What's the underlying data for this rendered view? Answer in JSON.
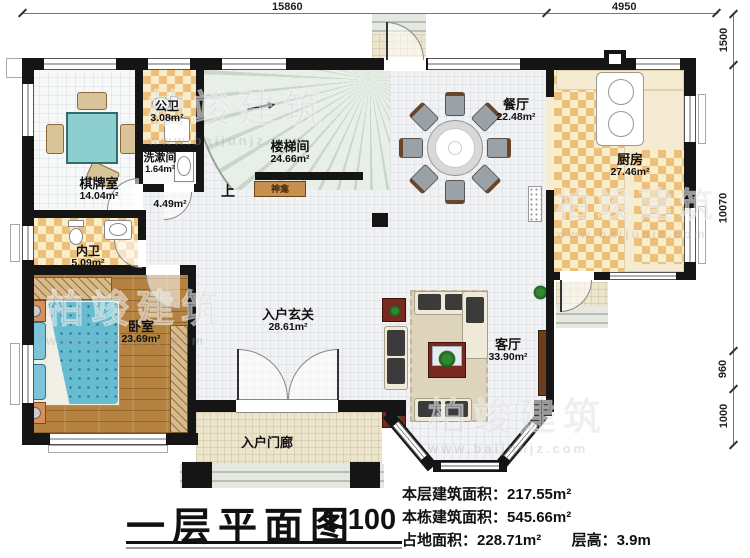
{
  "plan": {
    "title": "一层平面图",
    "scale": "1:100",
    "stats": {
      "line1_label": "本层建筑面积：",
      "line1_value": "217.55m²",
      "line2_label": "本栋建筑面积：",
      "line2_value": "545.66m²",
      "line3a_label": "占地面积：",
      "line3a_value": "228.71m²",
      "line3b_label": "层高：",
      "line3b_value": "3.9m"
    }
  },
  "dimensions": {
    "top_main": "15860",
    "top_right": "4950",
    "right_1": "1500",
    "right_2": "10070",
    "right_3": "960",
    "right_4": "1000"
  },
  "rooms": {
    "mahjong": {
      "name": "棋牌室",
      "area": "14.04m²"
    },
    "public_bath": {
      "name": "公卫",
      "area": "3.08m²"
    },
    "washroom": {
      "name": "洗漱间",
      "area": "1.64m²"
    },
    "stairwell": {
      "name": "楼梯间",
      "area": "24.66m²"
    },
    "corridor": {
      "area": "4.49m²"
    },
    "dining": {
      "name": "餐厅",
      "area": "22.48m²"
    },
    "kitchen": {
      "name": "厨房",
      "area": "27.46m²"
    },
    "private_bath": {
      "name": "内卫",
      "area": "5.09m²"
    },
    "bedroom": {
      "name": "卧室",
      "area": "23.69m²"
    },
    "foyer": {
      "name": "入户玄关",
      "area": "28.61m²"
    },
    "living": {
      "name": "客厅",
      "area": "33.90m²"
    },
    "porch": {
      "name": "入户门廊"
    },
    "shrine": {
      "name": "神龛"
    },
    "up_label": "上"
  },
  "watermark": {
    "brand": "柏竣建筑",
    "url": "www.baijunjz.com"
  }
}
